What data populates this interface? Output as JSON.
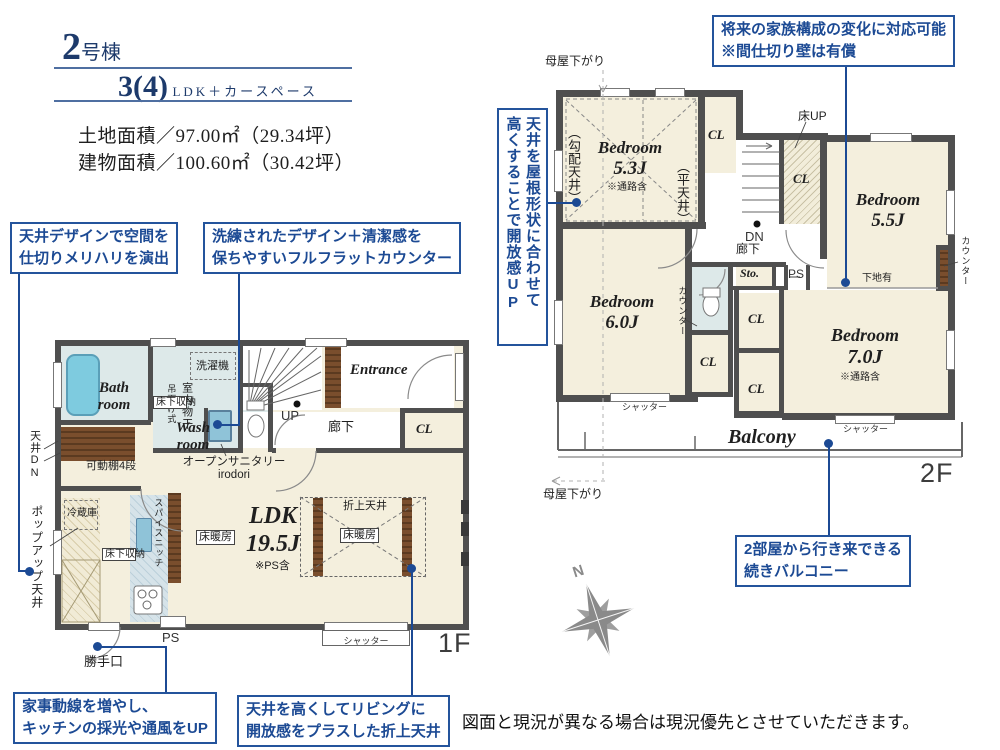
{
  "header": {
    "unit_number": "2",
    "unit_suffix": "号棟",
    "plan_type": "3(4)",
    "plan_suffix": "LDK＋カースペース",
    "land_area": "土地面積／97.00㎡（29.34坪）",
    "building_area": "建物面積／100.60㎡（30.42坪）"
  },
  "callouts": {
    "ceiling_design": {
      "l1": "天井デザインで空間を",
      "l2": "仕切りメリハリを演出"
    },
    "flat_counter": {
      "l1": "洗練されたデザイン＋清潔感を",
      "l2": "保ちやすいフルフラットカウンター"
    },
    "future_family": {
      "l1": "将来の家族構成の変化に対応可能",
      "l2": "※間仕切り壁は有償"
    },
    "roof_ceiling": {
      "l1": "天井を屋根形状に合わせて",
      "l2": "高くすることで開放感UP"
    },
    "housework": {
      "l1": "家事動線を増やし、",
      "l2": "キッチンの採光や通風をUP"
    },
    "living_ceiling": {
      "l1": "天井を高くしてリビングに",
      "l2": "開放感をプラスした折上天井"
    },
    "balcony": {
      "l1": "2部屋から行き来できる",
      "l2": "続きバルコニー"
    }
  },
  "f1": {
    "bath_l1": "Bath",
    "bath_l2": "room",
    "wash_l1": "Wash",
    "wash_l2": "room",
    "laundry": "洗濯機",
    "indoor_drying": "室内物干",
    "hanging": "吊下げ式",
    "underfloor": "床下収納",
    "shelf": "可動棚4段",
    "ceiling_dn": "天井DN",
    "popup_ceiling": "ポップアップ天井",
    "entrance": "Entrance",
    "corridor": "廊下",
    "cl": "CL",
    "up": "UP",
    "ldk_l1": "LDK",
    "ldk_l2": "19.5J",
    "ps_note": "※PS含",
    "floor_heating": "床暖房",
    "raised_ceiling": "折上天井",
    "fridge": "冷蔵庫",
    "spice_niche": "スパイスニッチ",
    "sanitary_l1": "オープンサニタリー",
    "sanitary_l2": "irodori",
    "ps": "PS",
    "back_door": "勝手口",
    "shutter": "シャッター",
    "floor_label": "1F"
  },
  "f2": {
    "bedroom": "Bedroom",
    "size53": "5.3J",
    "size55": "5.5J",
    "size60": "6.0J",
    "size70": "7.0J",
    "passage_note": "※通路含",
    "sloped_ceiling": "（勾配天井）",
    "flat_ceiling": "（平天井）",
    "cl": "CL",
    "dn": "DN",
    "corridor": "廊下",
    "floor_up": "床UP",
    "base_board": "下地有",
    "counter": "カウンター",
    "storage": "Sto.",
    "ps": "PS",
    "shutter": "シャッター",
    "balcony": "Balcony",
    "moya_sagari": "母屋下がり",
    "floor_label": "2F"
  },
  "footer": {
    "disclaimer": "図面と現況が異なる場合は現況優先とさせていただきます。"
  },
  "compass": {
    "north": "N"
  }
}
